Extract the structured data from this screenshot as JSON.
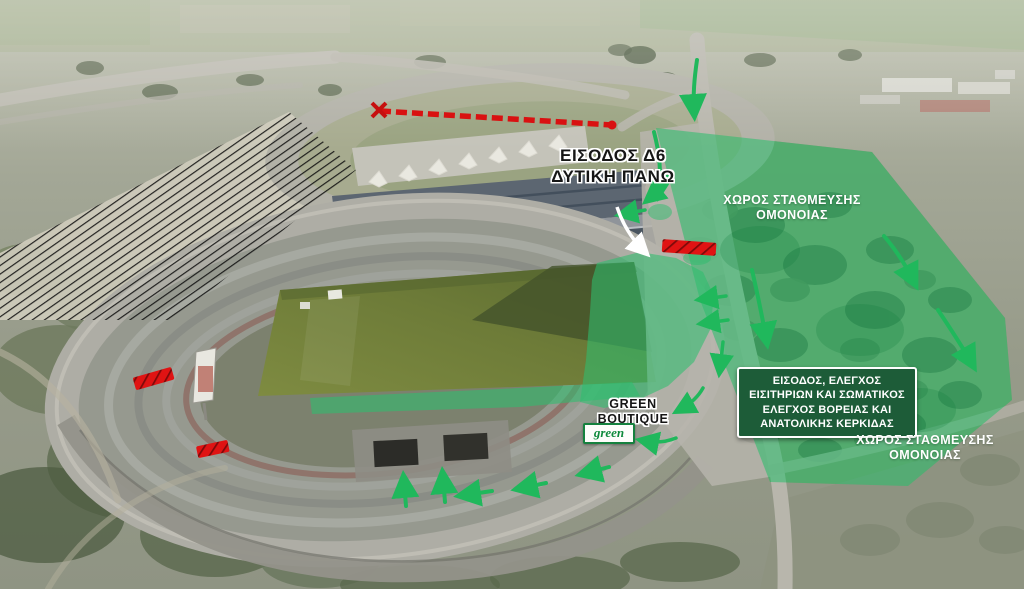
{
  "colors": {
    "highlight_green": "#2ebe6e",
    "arrow_green": "#20b85c",
    "checkpoint_bg": "#1d5c38",
    "barrier_red": "#e01313",
    "label_black": "#161616",
    "label_white": "#ffffff",
    "logo_green": "#0f8a3c"
  },
  "annotations": {
    "entrance_d6": {
      "line1": "ΕΙΣΟΔΟΣ Δ6",
      "line2": "ΔΥΤΙΚΗ ΠΑΝΩ"
    },
    "parking_north": {
      "line1": "ΧΩΡΟΣ ΣΤΑΘΜΕΥΣΗΣ",
      "line2": "ΟΜΟΝΟΙΑΣ"
    },
    "parking_south": {
      "line1": "ΧΩΡΟΣ ΣΤΑΘΜΕΥΣΗΣ",
      "line2": "ΟΜΟΝΟΙΑΣ"
    },
    "checkpoint": {
      "line1": "ΕΙΣΟΔΟΣ, ΕΛΕΓΧΟΣ",
      "line2": "ΕΙΣΙΤΗΡΙΩΝ ΚΑΙ ΣΩΜΑΤΙΚΟΣ",
      "line3": "ΕΛΕΓΧΟΣ ΒΟΡΕΙΑΣ ΚΑΙ",
      "line4": "ΑΝΑΤΟΛΙΚΗΣ ΚΕΡΚΙΔΑΣ"
    },
    "boutique": {
      "line1": "GREEN",
      "line2": "BOUTIQUE"
    },
    "boutique_logo": "green"
  }
}
